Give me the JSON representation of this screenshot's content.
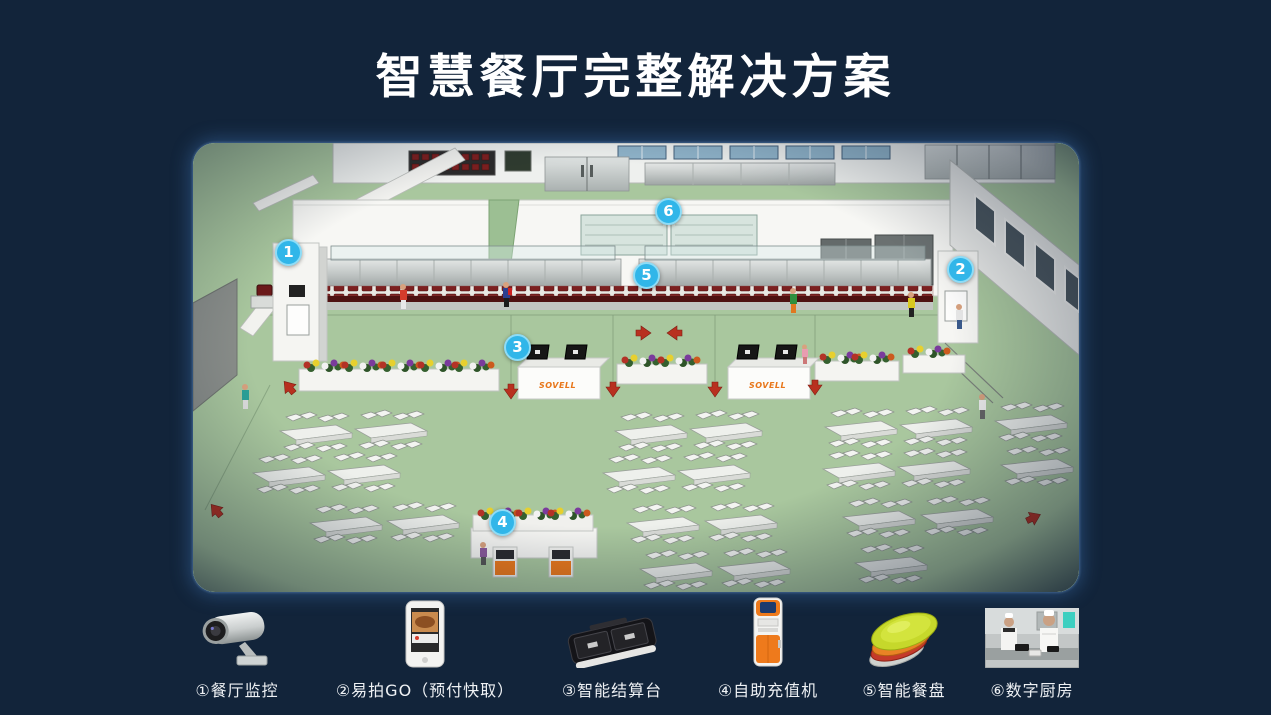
{
  "slide": {
    "title": "智慧餐厅完整解决方案"
  },
  "scene": {
    "counter_brand": "SOVELL",
    "markers": [
      {
        "num": "1"
      },
      {
        "num": "2"
      },
      {
        "num": "3"
      },
      {
        "num": "4"
      },
      {
        "num": "5"
      },
      {
        "num": "6"
      }
    ]
  },
  "legend": {
    "items": [
      {
        "icon": "cctv-camera-icon",
        "label": "①餐厅监控"
      },
      {
        "icon": "order-device-icon",
        "label": "②易拍GO（预付快取）"
      },
      {
        "icon": "settlement-terminal-icon",
        "label": "③智能结算台"
      },
      {
        "icon": "recharge-kiosk-icon",
        "label": "④自助充值机"
      },
      {
        "icon": "smart-plates-icon",
        "label": "⑤智能餐盘"
      },
      {
        "icon": "digital-kitchen-icon",
        "label": "⑥数字厨房"
      }
    ]
  },
  "colors": {
    "background": "#12243a",
    "marker_blue": "#31b6e9",
    "floor_green": "#a9c79e",
    "brand_orange": "#e8761a",
    "kiosk_orange": "#ee7a1c",
    "arrow_red": "#b8301f"
  }
}
